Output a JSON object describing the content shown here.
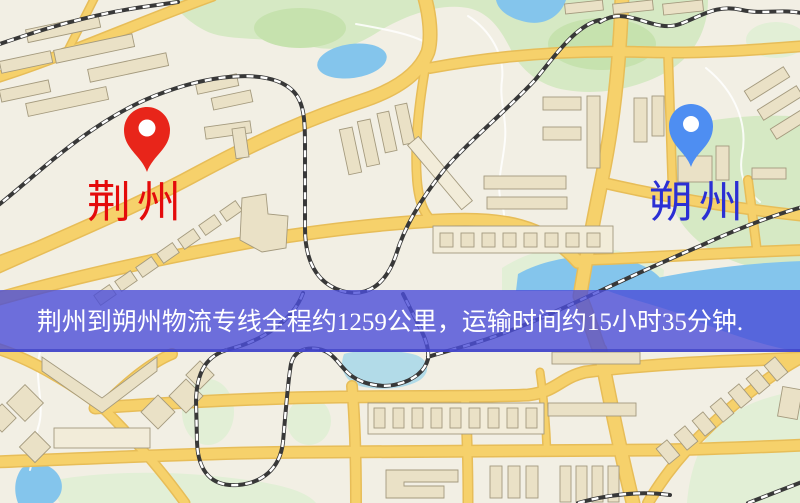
{
  "banner": {
    "text": "荆州到朔州物流专线全程约1259公里，运输时间约15小时35分钟.",
    "bg": "#4b4ed8",
    "bg_opacity": "0.80",
    "edge_color": "#3d40c4",
    "text_color": "#ffffff"
  },
  "markers": {
    "origin": {
      "label": "荆州",
      "label_color": "#e40b0b",
      "pin_color": "#e8251a"
    },
    "destination": {
      "label": "朔州",
      "label_color": "#2b2fd4",
      "pin_color": "#4e8ef2"
    }
  },
  "route": {
    "origin": "荆州",
    "destination": "朔州",
    "distance_text": "约1259公里",
    "duration_text": "约15小时35分钟"
  },
  "map_colors": {
    "land": "#f2efe4",
    "road": "#f6d16b",
    "road_casing": "#e7bd58",
    "building": "#eae1c6",
    "building_light": "#f2ecd9",
    "building_outline": "#a49a7e",
    "green": "#d6e9c4",
    "green_light": "#e2efd6",
    "green_dark": "#c6e2ae",
    "water": "#84c5ec",
    "water_light": "#b2dbe8",
    "stream": "#ffffff",
    "railway_dark": "#383838",
    "railway_light": "#ffffff"
  }
}
